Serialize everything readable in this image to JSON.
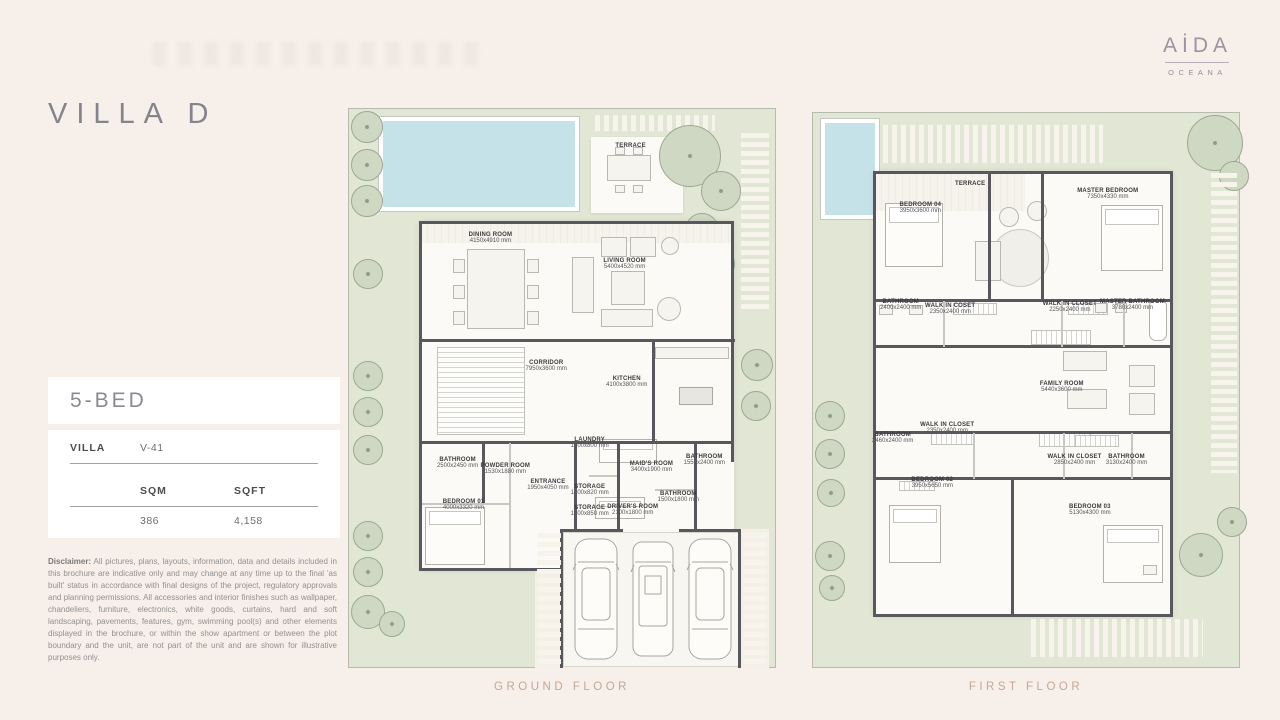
{
  "title": "VILLA D",
  "brand": {
    "name": "AİDA",
    "sub": "OCEANA"
  },
  "info": {
    "bed_label": "5-BED",
    "villa_label": "VILLA",
    "villa_value": "V-41",
    "col_sqm": "SQM",
    "col_sqft": "SQFT",
    "sqm": "386",
    "sqft": "4,158"
  },
  "disclaimer": {
    "label": "Disclaimer:",
    "text": "All pictures, plans, layouts, information, data and details included in this brochure are indicative only and may change at any time up to the final 'as built' status in accordance with final designs of the project, regulatory approvals and planning permissions. All accessories and interior finishes such as wallpaper, chandeliers, furniture, electronics, white goods, curtains, hard and soft landscaping, pavements, features, gym, swimming pool(s) and other elements displayed in the brochure, or within the show apartment or between the plot boundary and the unit, are not part of the unit and are shown for illustrative purposes only."
  },
  "colors": {
    "background": "#f7efe9",
    "garden": "#e2e6d4",
    "pool": "#c5e2e9",
    "wall": "#57575d",
    "caption": "#c5a795"
  },
  "floors": [
    {
      "caption": "GROUND FLOOR",
      "rooms": [
        {
          "name": "TERRACE",
          "dims": "",
          "x": 66.1,
          "y": 6.6
        },
        {
          "name": "DINING ROOM",
          "dims": "4150x4910 mm",
          "x": 33.2,
          "y": 23.2
        },
        {
          "name": "LIVING ROOM",
          "dims": "5400x4520 mm",
          "x": 64.7,
          "y": 27.7
        },
        {
          "name": "CORRIDOR",
          "dims": "7950x3600 mm",
          "x": 46.3,
          "y": 46.1
        },
        {
          "name": "KITCHEN",
          "dims": "4100x3800 mm",
          "x": 65.2,
          "y": 48.9
        },
        {
          "name": "BATHROOM",
          "dims": "2500x2450 mm",
          "x": 25.5,
          "y": 63.4
        },
        {
          "name": "POWDER ROOM",
          "dims": "1530x1880 mm",
          "x": 36.7,
          "y": 64.6
        },
        {
          "name": "BEDROOM 01",
          "dims": "4000x3320 mm",
          "x": 26.9,
          "y": 70.9
        },
        {
          "name": "ENTRANCE",
          "dims": "1950x4050 mm",
          "x": 46.7,
          "y": 67.3
        },
        {
          "name": "LAUNDRY",
          "dims": "1400x800 mm",
          "x": 56.5,
          "y": 59.8
        },
        {
          "name": "MAID'S ROOM",
          "dims": "3400x1900 mm",
          "x": 71.0,
          "y": 64.1
        },
        {
          "name": "BATHROOM",
          "dims": "1550x2400 mm",
          "x": 83.4,
          "y": 62.9
        },
        {
          "name": "STORAGE",
          "dims": "1400x820 mm",
          "x": 56.5,
          "y": 68.2
        },
        {
          "name": "STORAGE",
          "dims": "1400x850 mm",
          "x": 56.5,
          "y": 72.1
        },
        {
          "name": "DRIVER'S ROOM",
          "dims": "2100x1800 mm",
          "x": 66.6,
          "y": 71.8
        },
        {
          "name": "BATHROOM",
          "dims": "1500x1800 mm",
          "x": 77.3,
          "y": 69.6
        }
      ]
    },
    {
      "caption": "FIRST FLOOR",
      "rooms": [
        {
          "name": "TERRACE",
          "dims": "",
          "x": 36.9,
          "y": 12.9
        },
        {
          "name": "BEDROOM 04",
          "dims": "3950x3600 mm",
          "x": 25.2,
          "y": 17.1
        },
        {
          "name": "MASTER BEDROOM",
          "dims": "7350x4330 mm",
          "x": 69.2,
          "y": 14.6
        },
        {
          "name": "BATHROOM",
          "dims": "2400x2400 mm",
          "x": 20.6,
          "y": 34.7
        },
        {
          "name": "WALK IN COSET",
          "dims": "2350x2400 mm",
          "x": 32.2,
          "y": 35.3
        },
        {
          "name": "WALK IN CLOSET",
          "dims": "2250x2400 mm",
          "x": 60.3,
          "y": 35.1
        },
        {
          "name": "MASTER BATHROOM",
          "dims": "3780x2400 mm",
          "x": 75.0,
          "y": 34.7
        },
        {
          "name": "FAMILY ROOM",
          "dims": "5440x3600 mm",
          "x": 58.4,
          "y": 49.5
        },
        {
          "name": "BATHROOM",
          "dims": "2460x2400 mm",
          "x": 18.7,
          "y": 58.6
        },
        {
          "name": "WALK IN CLOSET",
          "dims": "2350x2400 mm",
          "x": 31.5,
          "y": 56.8
        },
        {
          "name": "BEDROOM 02",
          "dims": "3950x5650 mm",
          "x": 28.0,
          "y": 66.7
        },
        {
          "name": "WALK IN CLOSET",
          "dims": "2850x2400 mm",
          "x": 61.4,
          "y": 62.6
        },
        {
          "name": "BATHROOM",
          "dims": "3130x2400 mm",
          "x": 73.6,
          "y": 62.6
        },
        {
          "name": "BEDROOM 03",
          "dims": "5130x4300 mm",
          "x": 65.0,
          "y": 71.6
        }
      ]
    }
  ]
}
